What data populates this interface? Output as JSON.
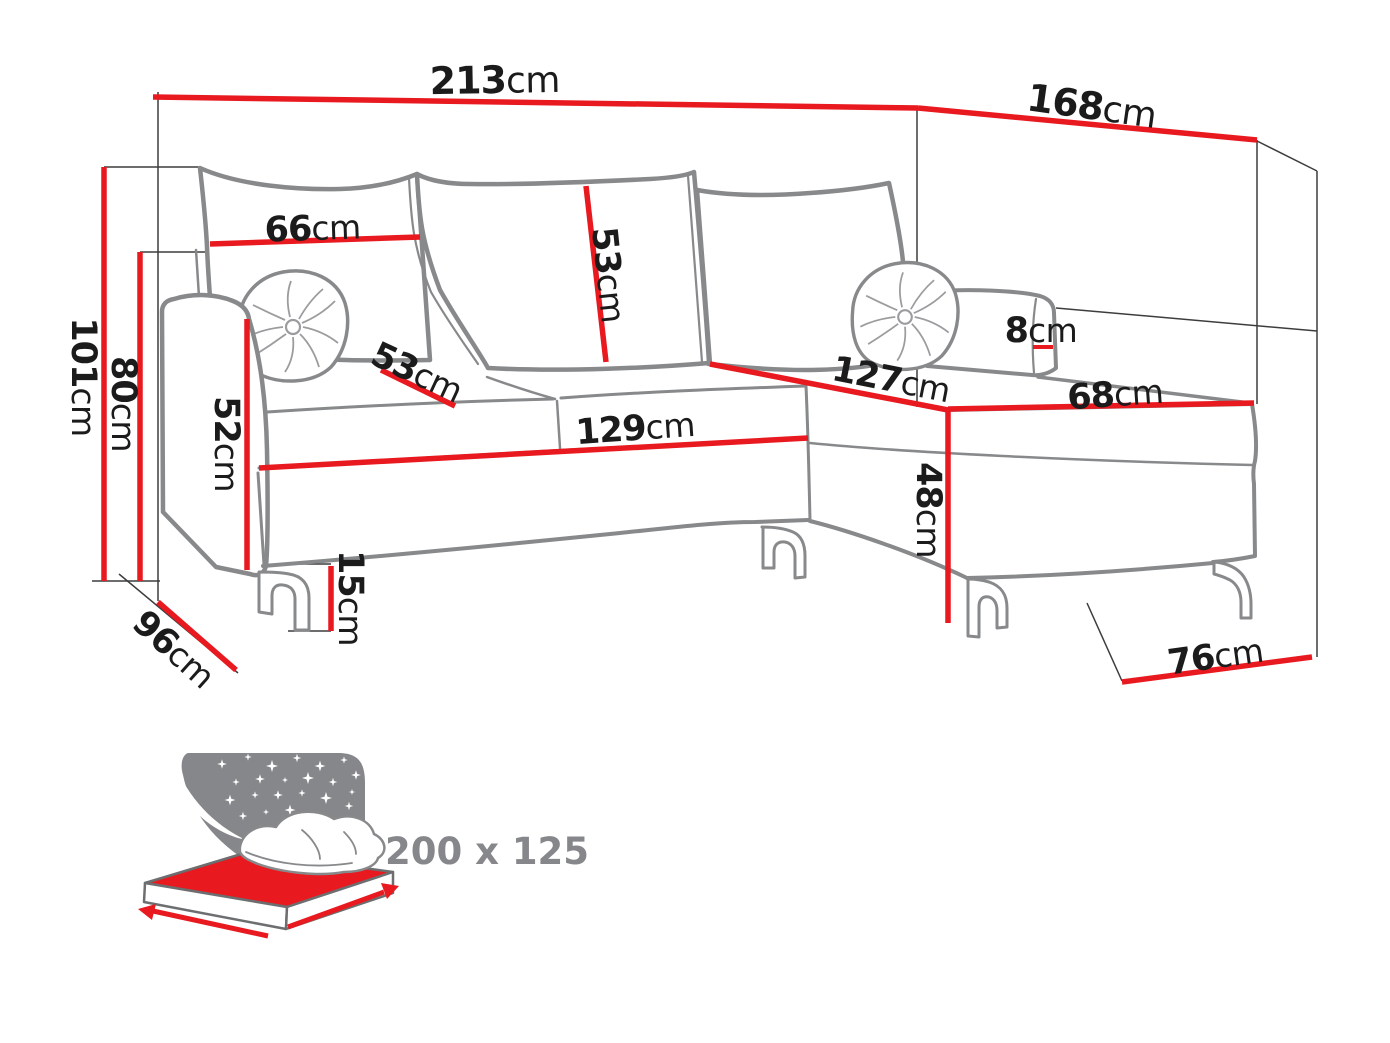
{
  "page": {
    "type": "product-dimension-diagram",
    "product": "corner sofa bed with chaise",
    "background": "#ffffff"
  },
  "unit": "cm",
  "colors": {
    "dimension_line": "#e8191f",
    "sofa_outline": "#87898b",
    "label_text": "#1b1b1b",
    "icon_gray": "#85878a"
  },
  "dimensions": {
    "total_width": "213",
    "total_depth": "168",
    "overall_height": "101",
    "back_height": "80",
    "back_cushion_width": "66",
    "back_cushion_height": "53",
    "back_rail_width": "8",
    "seat_depth": "53",
    "chaise_length": "127",
    "chaise_width": "68",
    "front_width": "129",
    "armrest_height": "52",
    "chaise_height": "48",
    "leg_height": "15",
    "sofa_depth": "96",
    "chaise_side_width": "76"
  },
  "sleeping_area": {
    "size": "200 x 125"
  },
  "icons": {
    "sleep_function": "bed-with-starry-sky-icon"
  }
}
